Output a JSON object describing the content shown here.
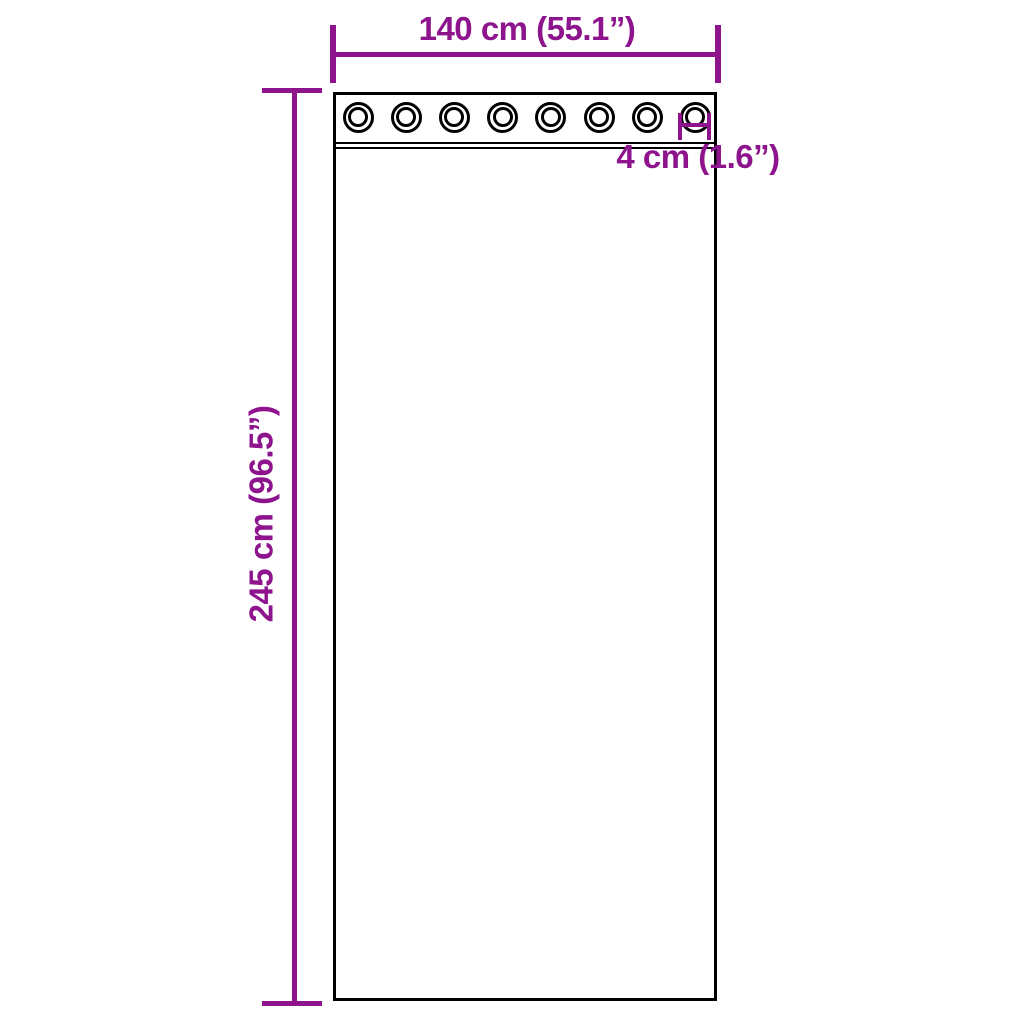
{
  "diagram": {
    "product": "curtain-with-grommets",
    "colors": {
      "dimension_color": "#8E148E",
      "outline_color": "#000000",
      "background": "#FFFFFF"
    },
    "curtain": {
      "grommet_count": 8
    },
    "dimensions": {
      "width": {
        "label": "140 cm (55.1”)"
      },
      "height": {
        "label": "245 cm (96.5”)"
      },
      "grommet_diameter": {
        "label": "4 cm (1.6”)"
      }
    }
  }
}
